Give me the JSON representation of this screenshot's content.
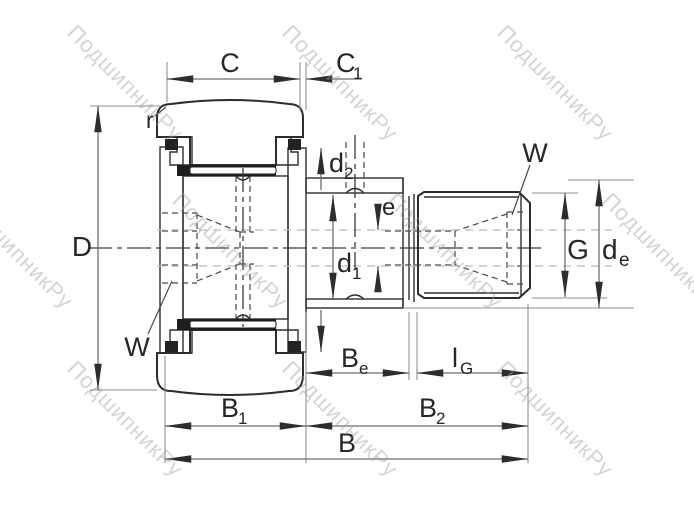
{
  "watermark": {
    "text": "ПодшипникРу",
    "color": "#cacaca"
  },
  "colors": {
    "background": "#ffffff",
    "outline": "#2d2d2d",
    "dimension_line": "#6e6e6e",
    "hidden_line": "#474747",
    "gray_axis": "#bcbcbc",
    "label_text": "#26262b"
  },
  "drawing": {
    "type": "technical-drawing",
    "view": "cross-section of stud-type track roller (cam follower) with eccentric collar and threaded stud"
  },
  "labels": {
    "C": {
      "base": "C"
    },
    "C1": {
      "base": "C",
      "sub": "1"
    },
    "r": {
      "base": "r"
    },
    "D": {
      "base": "D"
    },
    "W_left": {
      "base": "W"
    },
    "W_right": {
      "base": "W"
    },
    "d2": {
      "base": "d",
      "sub": "2"
    },
    "d1": {
      "base": "d",
      "sub": "1"
    },
    "e": {
      "base": "e"
    },
    "G": {
      "base": "G"
    },
    "de": {
      "base": "d",
      "sub": "e"
    },
    "Be": {
      "base": "B",
      "sub": "e"
    },
    "lG": {
      "base": "l",
      "sub": "G"
    },
    "B1": {
      "base": "B",
      "sub": "1"
    },
    "B2": {
      "base": "B",
      "sub": "2"
    },
    "B": {
      "base": "B"
    }
  }
}
